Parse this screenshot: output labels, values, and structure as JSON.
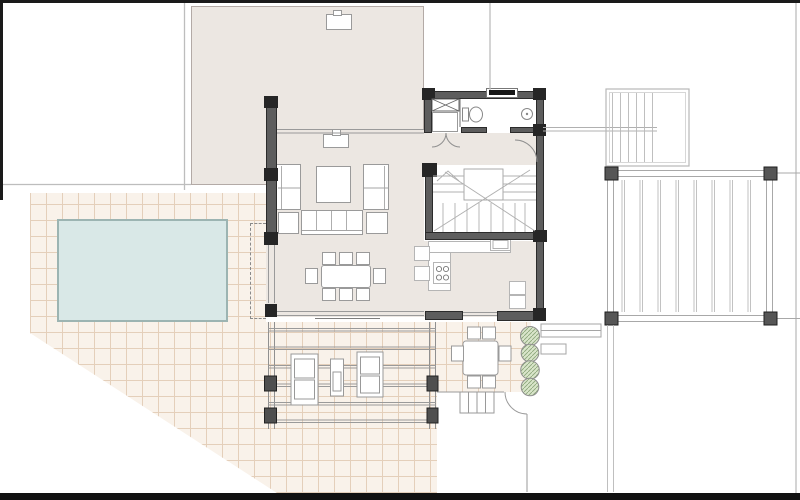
{
  "document": {
    "type": "architectural-floor-plan",
    "visible_text": [],
    "description_of_content": "ground floor plan of a villa with pool, tiled terrace, living room, dining area, kitchen, bathroom, staircase, lounge pergola, outdoor dining, side pergolas"
  },
  "colors": {
    "paper": "#ffffff",
    "frame_bar": "#1a1a1a",
    "floor_beige": "#ece7e2",
    "wall_gray": "#5d5d5d",
    "wall_joint_black": "#262626",
    "terrace_background": "#f9f2ea",
    "terrace_grid_line": "#e4cfba",
    "pool_water": "#d9e8e7",
    "pool_border": "#9cb4b2",
    "line_gray": "#9a9a9a",
    "boundary_line": "#bdbdbd",
    "bush_fill": "#d9e5ca",
    "bush_hatch": "#8aa478",
    "furniture_fill": "#ffffff"
  },
  "elements": {
    "outdoor": [
      "pool",
      "tiled-terrace",
      "lounge-pergola",
      "sun-loungers",
      "outdoor-side-table",
      "outdoor-dining-table",
      "outdoor-chairs",
      "bushes",
      "planter-bench",
      "exterior-steps",
      "east-pergola-large",
      "north-east-pergola-small",
      "walkway",
      "roof-overhang-dashed-line"
    ],
    "indoor": [
      "living-room-sofa-set",
      "coffee-table",
      "ottomans",
      "dining-table-8-chairs",
      "fireplace",
      "kitchen-l-counter",
      "cooktop",
      "kitchen-sink",
      "fridge-cabinets",
      "sideboard",
      "staircase",
      "bathroom",
      "toilet",
      "washbasin",
      "washing-machine",
      "storage-cabinet",
      "window",
      "door-arcs"
    ]
  }
}
